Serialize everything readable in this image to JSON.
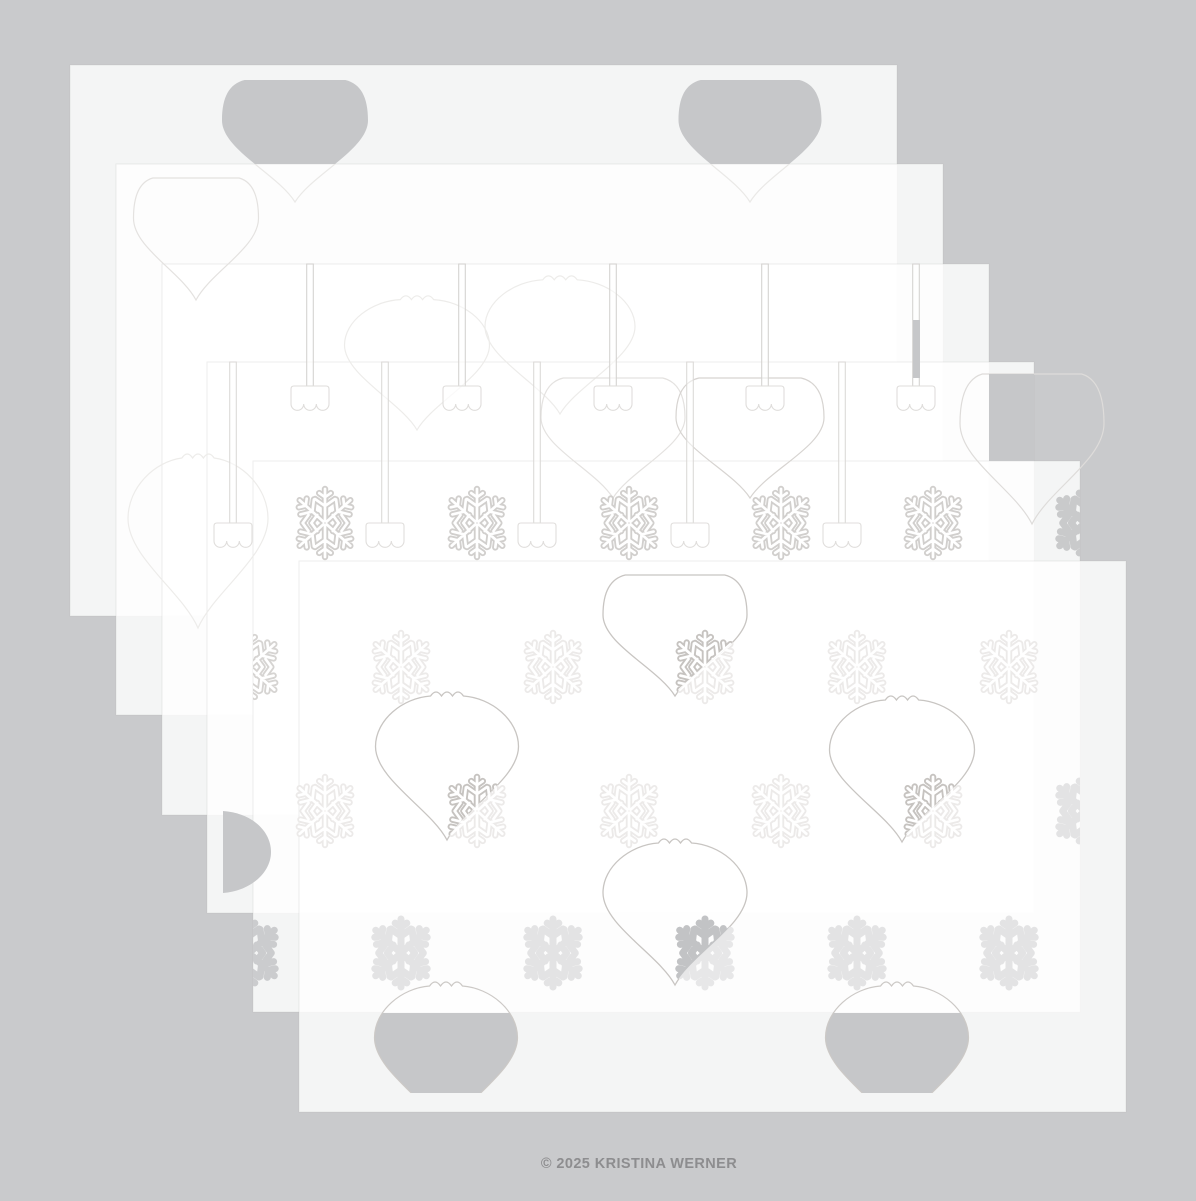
{
  "canvas": {
    "width": 1196,
    "height": 1196,
    "background": "#c9cacc"
  },
  "footer": {
    "copyright": "© 2025 KRISTINA WERNER",
    "color": "#8d8d8f"
  },
  "palette": {
    "background_gray": "#c9cacc",
    "cutout_gray": "#c6c7c9",
    "sheet_fill": "rgba(255,255,255,0.80)",
    "sheet_edge": "rgba(168,168,166,0.20)",
    "front_outline": "#c8c5c2",
    "crisp_flake": "#d1cfcd",
    "faint_flake": "#eceae9",
    "white": "#ffffff"
  },
  "icons": [
    "snowflake-icon",
    "ornament-cutout",
    "ornament-cap",
    "hanger-slot"
  ],
  "sheet_size": {
    "w": 827,
    "h": 551
  },
  "sheets": [
    {
      "name": "sheet-1",
      "x": 70,
      "y": 65
    },
    {
      "name": "sheet-2",
      "x": 116,
      "y": 164
    },
    {
      "name": "sheet-3",
      "x": 162,
      "y": 264
    },
    {
      "name": "sheet-4",
      "x": 207,
      "y": 362
    },
    {
      "name": "sheet-5",
      "x": 253,
      "y": 461
    },
    {
      "name": "sheet-6",
      "x": 299,
      "y": 561
    }
  ],
  "ornaments": [
    {
      "id": "s1-cut-left",
      "sheet": 1,
      "kind": "flat",
      "cx": 295,
      "top": 80,
      "w": 146,
      "h": 122,
      "style": "grayTop"
    },
    {
      "id": "s1-cut-right",
      "sheet": 1,
      "kind": "flat",
      "cx": 750,
      "top": 80,
      "w": 143,
      "h": 122,
      "style": "grayTop"
    },
    {
      "id": "s2-cut-left",
      "sheet": 2,
      "kind": "flat",
      "cx": 196,
      "top": 178,
      "w": 125,
      "h": 122,
      "style": "faint2"
    },
    {
      "id": "s2-watermark",
      "sheet": 2,
      "kind": "scallop",
      "cx": 198,
      "top": 450,
      "w": 140,
      "h": 178,
      "style": "faint3"
    },
    {
      "id": "s3-watermark-1",
      "sheet": 3,
      "kind": "scallop",
      "cx": 417,
      "top": 292,
      "w": 145,
      "h": 138,
      "style": "faint3"
    },
    {
      "id": "s3-watermark-2",
      "sheet": 3,
      "kind": "scallop",
      "cx": 560,
      "top": 272,
      "w": 150,
      "h": 142,
      "style": "faint3"
    },
    {
      "id": "s4-hanging-1",
      "sheet": 4,
      "kind": "flat",
      "cx": 613,
      "top": 378,
      "w": 144,
      "h": 120,
      "style": "faint2"
    },
    {
      "id": "s4-hanging-2",
      "sheet": 4,
      "kind": "flat",
      "cx": 750,
      "top": 378,
      "w": 148,
      "h": 120,
      "style": "mid"
    },
    {
      "id": "s4-cut-right",
      "sheet": 4,
      "kind": "flat",
      "cx": 1032,
      "top": 374,
      "w": 144,
      "h": 150,
      "style": "grayRight"
    },
    {
      "id": "s6-orn-top",
      "sheet": 6,
      "kind": "flat",
      "cx": 675,
      "top": 575,
      "w": 144,
      "h": 121,
      "style": "front",
      "flake": {
        "x": 705,
        "y": 667,
        "style": "outlineDark"
      }
    },
    {
      "id": "s6-orn-left",
      "sheet": 6,
      "kind": "scallop",
      "cx": 447,
      "top": 688,
      "w": 143,
      "h": 152,
      "style": "front",
      "flake": {
        "x": 477,
        "y": 811,
        "style": "outlineDark"
      }
    },
    {
      "id": "s6-orn-right",
      "sheet": 6,
      "kind": "scallop",
      "cx": 902,
      "top": 692,
      "w": 145,
      "h": 150,
      "style": "front",
      "flake": {
        "x": 933,
        "y": 811,
        "style": "outlineDark"
      }
    },
    {
      "id": "s6-orn-bottom",
      "sheet": 6,
      "kind": "scallop",
      "cx": 675,
      "top": 835,
      "w": 144,
      "h": 150,
      "style": "front",
      "flake": {
        "x": 705,
        "y": 953,
        "style": "solidDark"
      }
    },
    {
      "id": "s6-cut-bottom-a",
      "sheet": 6,
      "kind": "scallop",
      "cx": 446,
      "top": 978,
      "w": 143,
      "h": 155,
      "style": "grayBottom"
    },
    {
      "id": "s6-cut-bottom-b",
      "sheet": 6,
      "kind": "scallop",
      "cx": 897,
      "top": 978,
      "w": 143,
      "h": 155,
      "style": "grayBottom"
    }
  ],
  "hanger_rows": [
    {
      "sheet": 3,
      "xs": [
        310,
        462,
        613,
        765,
        916
      ],
      "y0": 264,
      "y1": 386,
      "slot_stroke": "#d5d3d1",
      "cap_stroke": "#dfdddb"
    },
    {
      "sheet": 4,
      "xs": [
        233,
        385,
        537,
        690,
        842
      ],
      "y0": 362,
      "y1": 523,
      "slot_stroke": "#dcdad8",
      "cap_stroke": "#e0dedc"
    }
  ],
  "extra_cutouts": [
    {
      "id": "s2-gray-slot",
      "type": "rect",
      "x": 913,
      "y": 320,
      "w": 7,
      "h": 58,
      "fill": "#c6c7c9"
    },
    {
      "id": "s4-left-half-ornament",
      "type": "path",
      "d": "M223,811 C252,813 271,831 271,852 C271,873 250,891 223,893 Z",
      "fill": "#c6c7c9"
    }
  ],
  "snowflake_grid": {
    "radius": 34,
    "clip": {
      "x": 253,
      "y": 461,
      "w": 827,
      "h": 551
    },
    "rows": [
      {
        "y": 523,
        "xs": [
          325,
          477,
          629,
          781,
          933,
          1085
        ],
        "styles": [
          "crisp",
          "crisp",
          "crisp",
          "crisp",
          "crisp",
          "solidCrisp"
        ]
      },
      {
        "y": 667,
        "xs": [
          249,
          401,
          553,
          705,
          857,
          1009
        ],
        "styles": [
          "crispL",
          "faint",
          "faint",
          "faint",
          "faint",
          "faint"
        ]
      },
      {
        "y": 811,
        "xs": [
          325,
          477,
          629,
          781,
          933,
          1085
        ],
        "styles": [
          "faint",
          "faint",
          "faint",
          "faint",
          "faint",
          "solidFaint"
        ]
      },
      {
        "y": 953,
        "xs": [
          249,
          401,
          553,
          705,
          857,
          1009
        ],
        "styles": [
          "solidCrisp2",
          "solidFaint",
          "solidFaint",
          "solidFaint2",
          "solidFaint",
          "solidFaint"
        ]
      }
    ]
  },
  "flake_styles": {
    "crisp": {
      "mode": "outline",
      "color": "#d1cfcd"
    },
    "crispL": {
      "mode": "outline",
      "color": "#d6d4d2"
    },
    "faint": {
      "mode": "outline",
      "color": "#eceae9"
    },
    "outlineDark": {
      "mode": "outline",
      "color": "#c6c3c0"
    },
    "solidCrisp": {
      "mode": "solid",
      "color": "#c9cacb"
    },
    "solidCrisp2": {
      "mode": "solid",
      "color": "#cbccce"
    },
    "solidFaint": {
      "mode": "solid",
      "color": "#e3e3e4"
    },
    "solidFaint2": {
      "mode": "solid",
      "color": "#e7e7e8"
    },
    "solidDark": {
      "mode": "solid",
      "color": "#c2c3c5"
    }
  },
  "ornament_styles": {
    "grayTop": {
      "gray_fill": "#c6c7c9",
      "lower_stroke": "#eae9e7"
    },
    "faint2": {
      "stroke": "#e4e2e0"
    },
    "faint3": {
      "stroke": "#edecea"
    },
    "mid": {
      "stroke": "#d7d4d1"
    },
    "front": {
      "stroke": "#c8c5c2",
      "inner_fill": "rgba(255,255,255,0.40)"
    },
    "grayRight": {
      "stroke": "#dedcda",
      "gray_fill": "#c6c7c9"
    },
    "grayBottom": {
      "stroke": "#ccc9c6",
      "gray_fill": "#c6c7c9",
      "inner_fill": "rgba(255,255,255,0.50)"
    }
  },
  "thresholds": {
    "sheet2_top": 164,
    "sheet4_right": 1034,
    "sheet4_bottom": 913,
    "sheet5_bottom": 1013,
    "gray_bottom_clip": 1093,
    "gray_right_clip": {
      "x": 989,
      "y": 374,
      "w": 45,
      "h": 87
    }
  }
}
